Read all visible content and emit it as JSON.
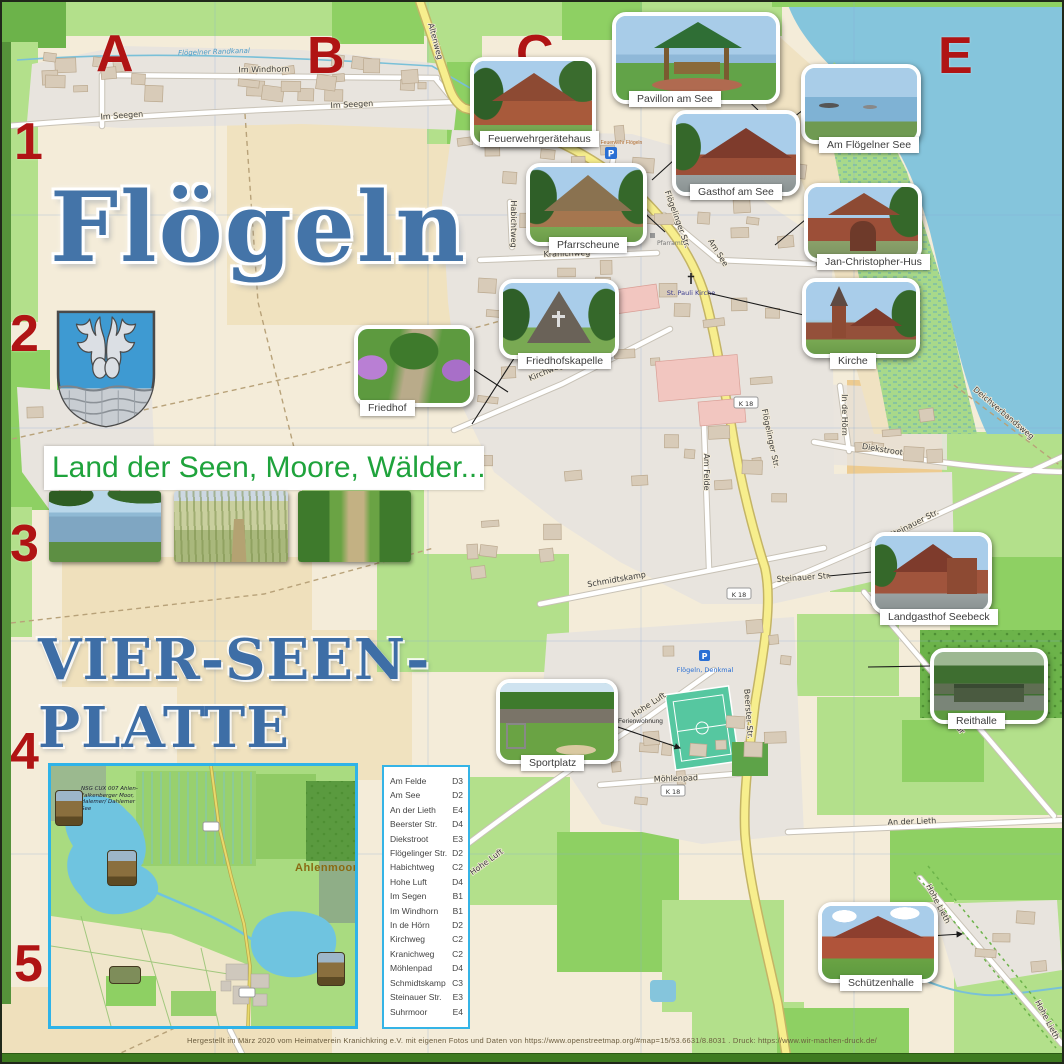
{
  "poster": {
    "title": "Flögeln",
    "band_text": "Land der Seen, Moore, Wälder...",
    "slogan_line1": "VIER-SEEN-",
    "slogan_line2": "PLATTE",
    "credit": "Hergestellt im März 2020 vom Heimatverein Kranichkring e.V. mit eigenen Fotos und Daten von https://www.openstreetmap.org/#map=15/53.6631/8.8031 . Druck: https://www.wir-machen-druck.de/"
  },
  "grid": {
    "cols": [
      "A",
      "B",
      "C",
      "D",
      "E"
    ],
    "rows": [
      "1",
      "2",
      "3",
      "4",
      "5"
    ]
  },
  "pois": {
    "feuerwehr": "Feuerwehrgerätehaus",
    "pavillon": "Pavillon am See",
    "floegelner_see": "Am Flögelner See",
    "gasthof": "Gasthof am See",
    "pfarrscheune": "Pfarrscheune",
    "jch": "Jan-Christopher-Hus",
    "kirche": "Kirche",
    "kapelle": "Friedhofskapelle",
    "friedhof": "Friedhof",
    "sportplatz": "Sportplatz",
    "seebeck": "Landgasthof Seebeck",
    "reithalle": "Reithalle",
    "schuetzenhalle": "Schützenhalle"
  },
  "map_labels": {
    "canal": "Flögelner Randkanal",
    "im_windhorn": "Im Windhorn",
    "im_seegen": "Im Seegen",
    "altenweg": "Altenweg",
    "kranichweg": "Kranichweg",
    "habichtweg": "Habichtweg",
    "kirchweg": "Kirchweg",
    "am_see": "Am See",
    "floegelinger": "Flögelinger Str.",
    "am_felde": "Am Felde",
    "schmidtskamp": "Schmidtskamp",
    "hohe_luft": "Hohe Luft",
    "moehlenpad": "Möhlenpad",
    "diekstroot": "Diekstroot",
    "in_de_hoern": "In de Hörn",
    "steinauer": "Steinauer Str.",
    "suhrmoor": "Suhrmoor",
    "an_der_lieth": "An der Lieth",
    "beerster": "Beerster Str.",
    "hohe_lieth": "Hohe Lieth",
    "deichverbandsweg": "Deichverbandsweg",
    "k18": "K 18",
    "st_pauli": "St. Pauli Kirche",
    "pfarramt": "Pfarramt",
    "feuerwehr_station": "Freiwillige Feuerwehr Flögeln",
    "denkmal": "Flögeln, Denkmal",
    "ferienwohnung": "Ferienwohnung",
    "parking": "P"
  },
  "street_index": {
    "entries": [
      {
        "street": "Am Felde",
        "ref": "D3"
      },
      {
        "street": "Am See",
        "ref": "D2"
      },
      {
        "street": "An der Lieth",
        "ref": "E4"
      },
      {
        "street": "Beerster Str.",
        "ref": "D4"
      },
      {
        "street": "Diekstroot",
        "ref": "E3"
      },
      {
        "street": "Flögelinger Str.",
        "ref": "D2"
      },
      {
        "street": "Habichtweg",
        "ref": "C2"
      },
      {
        "street": "Hohe Luft",
        "ref": "D4"
      },
      {
        "street": "Im Segen",
        "ref": "B1"
      },
      {
        "street": "Im Windhorn",
        "ref": "B1"
      },
      {
        "street": "In de Hörn",
        "ref": "D2"
      },
      {
        "street": "Kirchweg",
        "ref": "C2"
      },
      {
        "street": "Kranichweg",
        "ref": "C2"
      },
      {
        "street": "Möhlenpad",
        "ref": "D4"
      },
      {
        "street": "Schmidtskamp",
        "ref": "C3"
      },
      {
        "street": "Steinauer Str.",
        "ref": "E3"
      },
      {
        "street": "Suhrmoor",
        "ref": "E4"
      }
    ]
  },
  "inset": {
    "ahlenmoor": "Ahlenmoor",
    "nsg": "NSG CUX 007 Ahlen-Falkenberger Moor, Halemer/ Dahlemer See"
  },
  "colors": {
    "accent_red": "#b01414",
    "title_blue": "#4474a8",
    "slogan_green": "#1fa33c",
    "water": "#85c5dc",
    "road_yellow": "#f7ee8d",
    "index_border": "#35b4e6"
  }
}
